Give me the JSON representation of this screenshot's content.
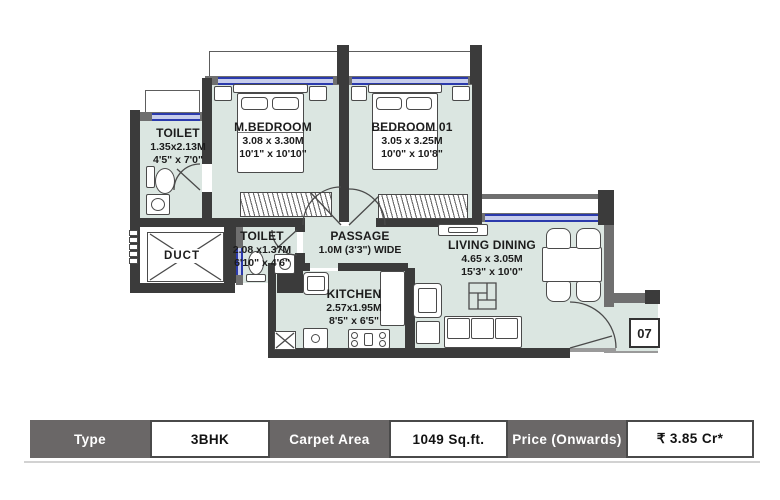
{
  "floor_plan": {
    "unit_number": "07",
    "rooms": {
      "master_bedroom": {
        "name": "M.BEDROOM",
        "dim_m": "3.08 x 3.30M",
        "dim_ft": "10'1\" x 10'10\""
      },
      "bedroom01": {
        "name": "BEDROOM 01",
        "dim_m": "3.05 x 3.25M",
        "dim_ft": "10'0\" x 10'8\""
      },
      "toilet1": {
        "name": "TOILET",
        "dim_m": "1.35x2.13M",
        "dim_ft": "4'5\" x 7'0\""
      },
      "toilet2": {
        "name": "TOILET",
        "dim_m": "2.08 x1.37M",
        "dim_ft": "6'10\" x 4'6\""
      },
      "passage": {
        "name": "PASSAGE",
        "dim_m": "1.0M (3'3\") WIDE"
      },
      "kitchen": {
        "name": "KITCHEN",
        "dim_m": "2.57x1.95M",
        "dim_ft": "8'5\" x 6'5\""
      },
      "living_dining": {
        "name": "LIVING DINING",
        "dim_m": "4.65 x 3.05M",
        "dim_ft": "15'3\" x 10'0\""
      },
      "duct": {
        "name": "DUCT"
      }
    }
  },
  "info_table": {
    "cells": [
      {
        "label": "Type",
        "style": "header"
      },
      {
        "label": "3BHK",
        "style": "value"
      },
      {
        "label": "Carpet Area",
        "style": "header"
      },
      {
        "label": "1049 Sq.ft.",
        "style": "value"
      },
      {
        "label": "Price (Onwards)",
        "style": "header"
      },
      {
        "label": "₹ 3.85 Cr*",
        "style": "value"
      }
    ]
  },
  "colors": {
    "wall_dark": "#3b3b3b",
    "wall_gray": "#6f6f6f",
    "room_fill": "#dbe6e1",
    "window_blue": "#2b3aac",
    "table_header_bg": "#6a6767"
  }
}
